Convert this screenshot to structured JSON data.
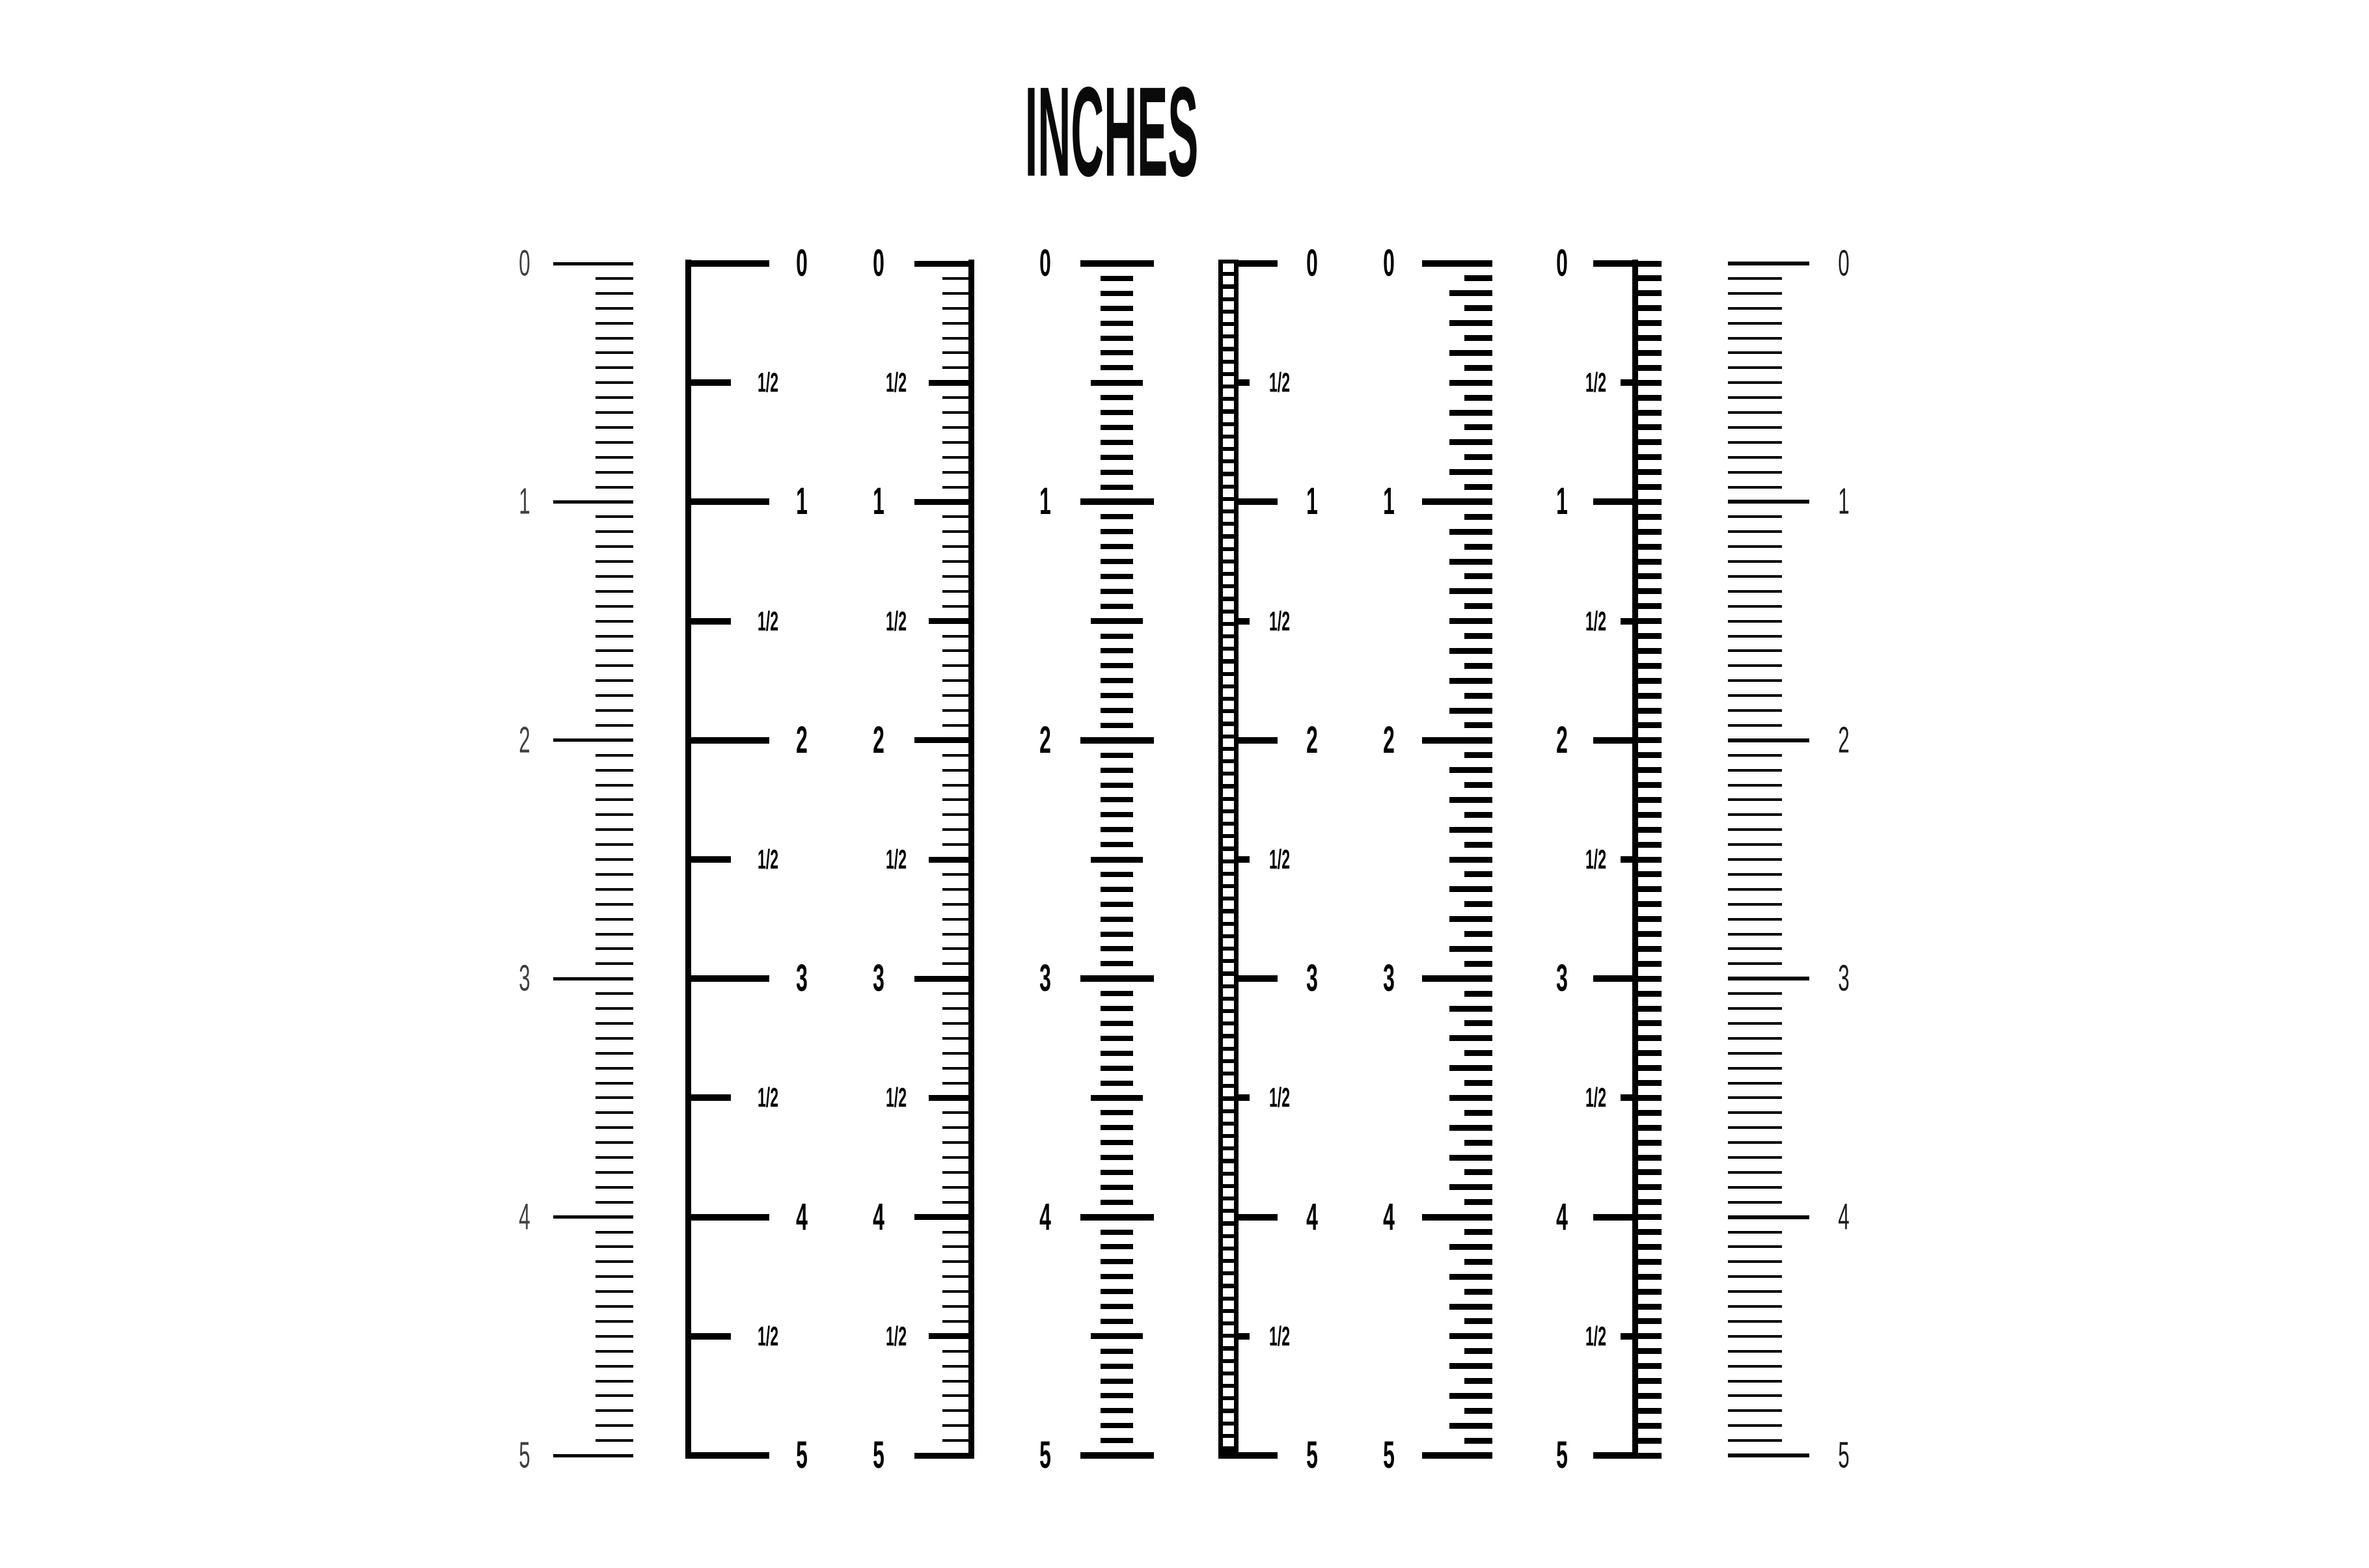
{
  "title": "INCHES",
  "background_color": "#ffffff",
  "ink_color": "#000000",
  "scale": {
    "unit": "inch",
    "min": 0,
    "max": 5,
    "subdivisions_per_inch": 16,
    "integer_labels": [
      "0",
      "1",
      "2",
      "3",
      "4",
      "5"
    ],
    "half_label": "1/2"
  },
  "rulers": [
    {
      "id": "ruler-1",
      "style": "fine-ticks-right-aligned",
      "label_side": "left",
      "labels": "integers",
      "number_style": "thin",
      "number_color": "#3f3f3f"
    },
    {
      "id": "ruler-2",
      "style": "left-spine-half-ticks",
      "label_side": "right",
      "labels": "integers-and-halves",
      "number_style": "bold",
      "number_color": "#000000"
    },
    {
      "id": "ruler-3",
      "style": "right-spine-fine-ticks",
      "label_side": "left",
      "labels": "integers-and-halves",
      "number_style": "bold",
      "number_color": "#000000"
    },
    {
      "id": "ruler-4",
      "style": "centered-dashes",
      "label_side": "left",
      "labels": "integers",
      "number_style": "bold",
      "number_color": "#000000"
    },
    {
      "id": "ruler-5",
      "style": "ladder-strip",
      "label_side": "right",
      "labels": "integers-and-halves",
      "number_style": "bold",
      "number_color": "#000000"
    },
    {
      "id": "ruler-6",
      "style": "alternating-dashes",
      "label_side": "left",
      "labels": "integers",
      "number_style": "bold",
      "number_color": "#000000"
    },
    {
      "id": "ruler-7",
      "style": "spine-right-dashes",
      "label_side": "left",
      "labels": "integers-and-halves",
      "number_style": "bold",
      "number_color": "#000000"
    },
    {
      "id": "ruler-8",
      "style": "fine-ticks-left-aligned",
      "label_side": "right",
      "labels": "integers",
      "number_style": "thin",
      "number_color": "#1c1c1c"
    }
  ]
}
